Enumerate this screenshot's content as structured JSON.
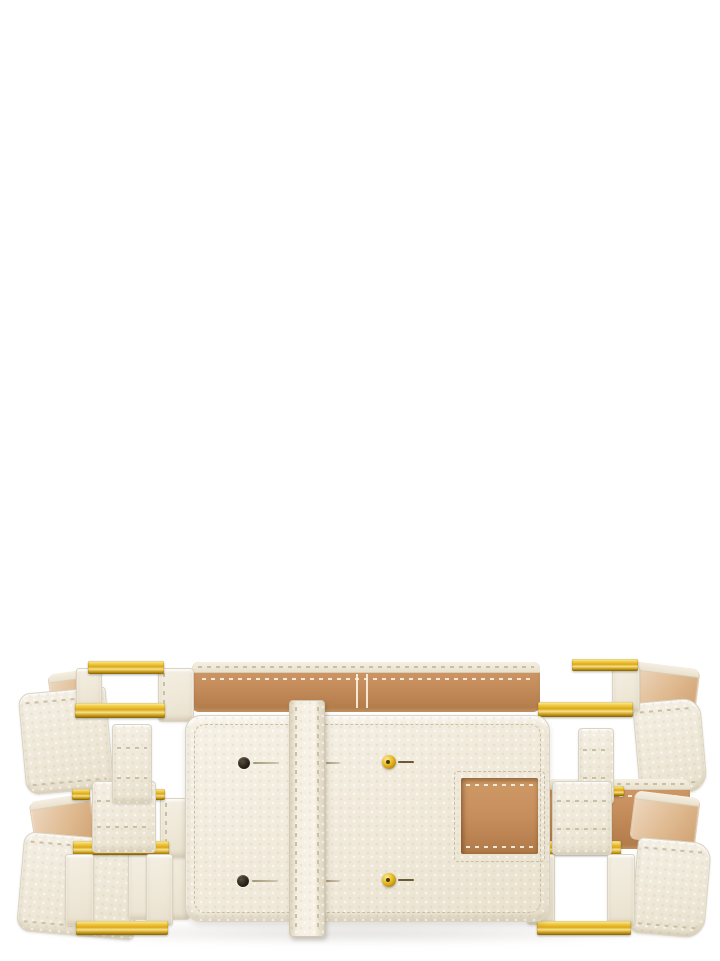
{
  "scene": {
    "type": "product-photograph",
    "description": "Cream-white pebbled leather wide belt with two parallel straps, gold-tone square buckles at each end, leather keeper loops, and a wide central panel with punch holes, gold studs and a cut-out slot showing the tan leather lining. Plain white studio background.",
    "background_color": "#ffffff"
  },
  "product": {
    "name": "Double-strap leather belt",
    "material": "grained leather",
    "exterior_color_name": "cream white",
    "lining_color_name": "tan",
    "hardware_color_name": "polished gold",
    "features": {
      "straps": 2,
      "square_buckles": 4,
      "keeper_loops": 4,
      "center_keeper_strap": 1,
      "punch_holes": 2,
      "gold_studs": 2,
      "panel_slot_openings": 1
    }
  },
  "colors": {
    "background": "#ffffff",
    "cream": "#f4efe3",
    "creamDeep": "#e8e0cc",
    "creamEdge": "#dbd3bf",
    "stitch": "#c9bfa6",
    "tan": "#c68e5c",
    "tanDeep": "#b07a48",
    "tanLight": "#e0bb92",
    "gold": "#dca81a",
    "goldLight": "#f8e187",
    "goldDeep": "#8d6906",
    "black": "#241e16"
  }
}
